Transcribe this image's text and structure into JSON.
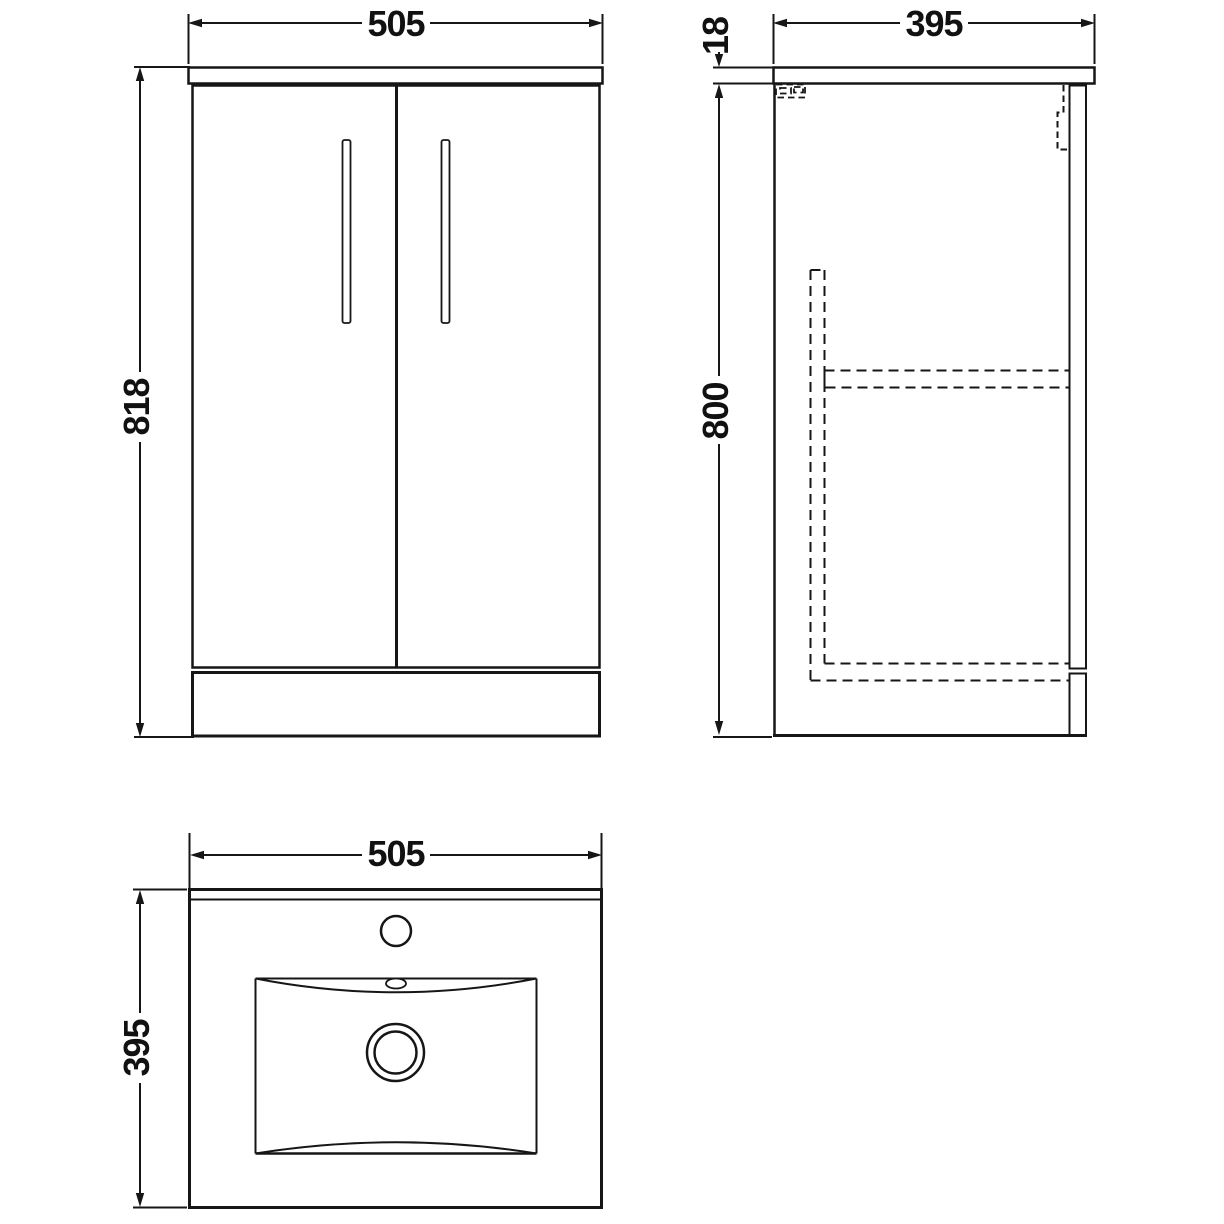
{
  "views": {
    "front": {
      "width": "505",
      "height": "818"
    },
    "side": {
      "depth": "395",
      "worktop_thickness": "18",
      "body_height": "800"
    },
    "plan": {
      "width": "505",
      "depth": "395"
    }
  },
  "style": {
    "line_color": "#161616",
    "background": "#ffffff"
  }
}
